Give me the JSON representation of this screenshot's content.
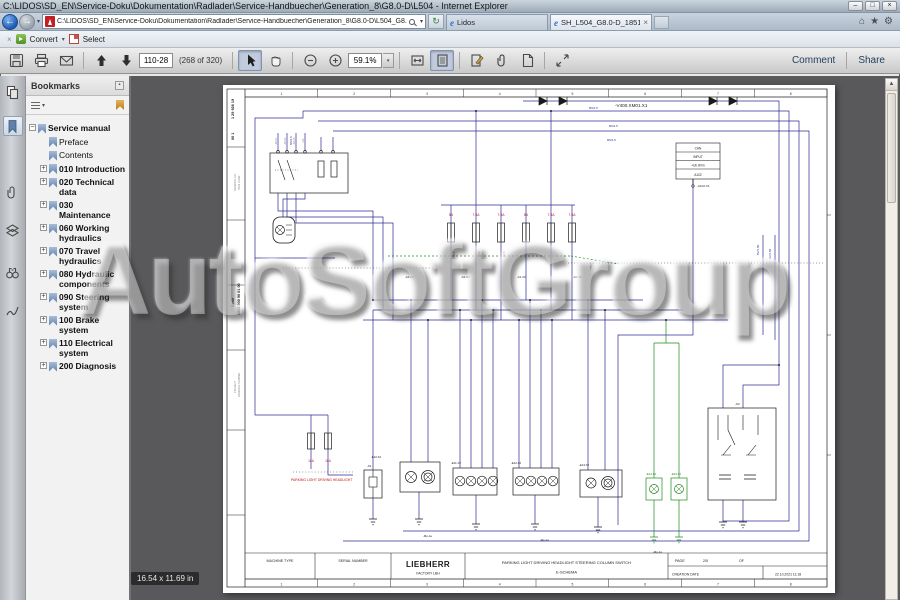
{
  "window": {
    "title": "C:\\LIDOS\\SD_EN\\Service-Doku\\Dokumentation\\Radlader\\Service-Handbuecher\\Generation_8\\G8.0-D\\L504 - Internet Explorer",
    "controls": {
      "minimize": "–",
      "restore": "□",
      "close": "×"
    }
  },
  "glyphs": {
    "back": "←",
    "forward": "→",
    "caret": "▾",
    "refresh": "↻",
    "home": "⌂",
    "star": "★",
    "gear": "⚙",
    "ie": "e",
    "tab_close": "×",
    "toolbar_close": "×",
    "scroll_up": "▲"
  },
  "nav": {
    "address": "C:\\LIDOS\\SD_EN\\Service-Doku\\Dokumentation\\Radlader\\Service-Handbuecher\\Generation_8\\G8.0-D\\L504_G8.0-D_1851\\SH_L504_G8.0-D_18",
    "tabs": [
      {
        "label": "Lidos",
        "active": false
      },
      {
        "label": "SH_L504_G8.0-D_1851_202...",
        "active": true
      }
    ]
  },
  "command_bar": {
    "convert_label": "Convert",
    "select_label": "Select"
  },
  "pdf_toolbar": {
    "page_field": "110-28",
    "page_count": "(268 of 320)",
    "zoom_value": "59.1%",
    "comment_label": "Comment",
    "share_label": "Share"
  },
  "bookmarks": {
    "header": "Bookmarks",
    "items": [
      {
        "label": "Service manual",
        "expander": "−"
      },
      {
        "label": "Preface",
        "expander": ""
      },
      {
        "label": "Contents",
        "expander": ""
      },
      {
        "label": "010 Introduction",
        "expander": "+"
      },
      {
        "label": "020 Technical data",
        "expander": "+"
      },
      {
        "label": "030 Maintenance",
        "expander": "+"
      },
      {
        "label": "060 Working hydraulics",
        "expander": "+"
      },
      {
        "label": "070 Travel hydraulics",
        "expander": "+"
      },
      {
        "label": "080 Hydraulic components",
        "expander": "+"
      },
      {
        "label": "090 Steering system",
        "expander": "+"
      },
      {
        "label": "100 Brake system",
        "expander": "+"
      },
      {
        "label": "110 Electrical system",
        "expander": "+"
      },
      {
        "label": "200 Diagnosis",
        "expander": "+"
      }
    ]
  },
  "watermark": {
    "text": "AutoSoftGroup"
  },
  "doc": {
    "size_tooltip": "16.54 x 11.69 in",
    "title_block": {
      "machine_type_label": "MACHINE TYPE",
      "serial_number_label": "SERIAL NUMBER",
      "brand": "LIEBHERR",
      "factory": "FACTORY  LBH",
      "title_line1": "PARKING LIGHT DRIVING HEADLIGHT STEERING COLUMN SWITCH",
      "title_line2": "E-SCHEMA",
      "page_label": "PAGE",
      "page_value": "2/5",
      "of_label": "OF",
      "creation_label": "CREATION DATE",
      "creation_value": "22.10.2021 11:18"
    },
    "schematic": {
      "columns": [
        "1",
        "2",
        "3",
        "4",
        "5",
        "6",
        "7",
        "8"
      ],
      "colors": {
        "wire_blue": "#2c2c96",
        "wire_green": "#1e8a1e",
        "label_red": "#c11212",
        "ink": "#1a1a1a"
      },
      "labels": [
        {
          "t": "-V400.XM01.X1",
          "x": 392,
          "y": 22,
          "fs": 4.6
        },
        {
          "t": "1 29 928 19",
          "x": 11,
          "y": 34,
          "fs": 3.8,
          "r": -90,
          "b": 1
        },
        {
          "t": "00 1",
          "x": 11,
          "y": 55,
          "fs": 3.8,
          "r": -90,
          "b": 1
        },
        {
          "t": "ITEM CODE",
          "x": 17,
          "y": 105,
          "c": "gr",
          "fs": 2.6,
          "r": -90
        },
        {
          "t": "DRAWING NO.",
          "x": 13,
          "y": 106,
          "c": "gr",
          "fs": 2.6,
          "r": -90
        },
        {
          "t": "Serie",
          "x": 11,
          "y": 222,
          "fs": 3.8,
          "r": -90,
          "b": 1
        },
        {
          "t": "1853 000 90 01 00",
          "x": 17,
          "y": 230,
          "fs": 3.8,
          "r": -90,
          "b": 1
        },
        {
          "t": "PROJECT",
          "x": 13,
          "y": 308,
          "c": "gr",
          "fs": 2.6,
          "r": -90
        },
        {
          "t": "DRAWING NUMBER",
          "x": 17,
          "y": 312,
          "c": "gr",
          "fs": 2.6,
          "r": -90
        },
        {
          "t": "5A",
          "x": 228,
          "y": 131,
          "c": "r",
          "fs": 3.4,
          "a": "m"
        },
        {
          "t": "7.5A",
          "x": 253,
          "y": 131,
          "c": "r",
          "fs": 3.4,
          "a": "m"
        },
        {
          "t": "7.5A",
          "x": 278,
          "y": 131,
          "c": "r",
          "fs": 3.4,
          "a": "m"
        },
        {
          "t": "5A",
          "x": 303,
          "y": 131,
          "c": "r",
          "fs": 3.4,
          "a": "m"
        },
        {
          "t": "7.5A",
          "x": 328,
          "y": 131,
          "c": "r",
          "fs": 3.4,
          "a": "m"
        },
        {
          "t": "7.5A",
          "x": 349,
          "y": 131,
          "c": "r",
          "fs": 3.4,
          "a": "m"
        },
        {
          "t": "M4.8",
          "x": 232,
          "y": 172,
          "c": "r",
          "fs": 2.4,
          "r": -90
        },
        {
          "t": "M4.8",
          "x": 257,
          "y": 172,
          "c": "r",
          "fs": 2.4,
          "r": -90
        },
        {
          "t": "M4.8",
          "x": 282,
          "y": 172,
          "c": "r",
          "fs": 2.4,
          "r": -90
        },
        {
          "t": "10A",
          "x": 88,
          "y": 377,
          "c": "r",
          "fs": 3.2,
          "a": "m"
        },
        {
          "t": "10A",
          "x": 105,
          "y": 377,
          "c": "r",
          "fs": 3.2,
          "a": "m"
        },
        {
          "t": "PARKING LIGHT DRIVING HEADLIGHT",
          "x": 68,
          "y": 396,
          "c": "r",
          "fs": 3.4
        },
        {
          "t": "CAN",
          "x": 475,
          "y": 64.5,
          "fs": 3.2,
          "a": "m"
        },
        {
          "t": "INPUT",
          "x": 475,
          "y": 73,
          "fs": 3.2,
          "a": "m"
        },
        {
          "t": "+Ub  8Vm",
          "x": 475,
          "y": 81.5,
          "fs": 3.2,
          "a": "m"
        },
        {
          "t": "A102",
          "x": 475,
          "y": 91,
          "fs": 3.2,
          "a": "m"
        },
        {
          "t": "-A102.X1",
          "x": 474,
          "y": 102,
          "fs": 3
        },
        {
          "t": "8V/1.50",
          "x": 536,
          "y": 170,
          "c": "b",
          "fs": 3,
          "r": -90
        },
        {
          "t": "9V/1.50",
          "x": 548,
          "y": 174,
          "c": "b",
          "fs": 3,
          "r": -90
        },
        {
          "t": "8N/1.5",
          "x": 366,
          "y": 24,
          "c": "b",
          "fs": 3
        },
        {
          "t": "8N/1.5",
          "x": 386,
          "y": 42,
          "c": "b",
          "fs": 3
        },
        {
          "t": "8N/1.5",
          "x": 384,
          "y": 56,
          "c": "b",
          "fs": 3
        },
        {
          "t": "8N/1.5",
          "x": 69,
          "y": 60,
          "c": "b",
          "fs": 3,
          "r": -90
        },
        {
          "t": "-S8.X1",
          "x": 54,
          "y": 60,
          "c": "gr",
          "fs": 2.4,
          "r": -90
        },
        {
          "t": "-S8.X2",
          "x": 63,
          "y": 60,
          "c": "gr",
          "fs": 2.4,
          "r": -90
        },
        {
          "t": "-S8.X3",
          "x": 72,
          "y": 60,
          "c": "gr",
          "fs": 2.4,
          "r": -90
        },
        {
          "t": "+S3",
          "x": 81,
          "y": 58,
          "c": "gr",
          "fs": 2.4,
          "r": -90
        },
        {
          "t": "-A1.X2",
          "x": 182,
          "y": 193,
          "fs": 2.8
        },
        {
          "t": "-A1.X2",
          "x": 238,
          "y": 193,
          "fs": 2.8
        },
        {
          "t": "-A1.X2",
          "x": 294,
          "y": 193,
          "fs": 2.8
        },
        {
          "t": "-A1.X2",
          "x": 350,
          "y": 193,
          "fs": 2.8
        },
        {
          "t": "-E10.X2",
          "x": 148,
          "y": 373,
          "fs": 2.8
        },
        {
          "t": "-E11.X2",
          "x": 228,
          "y": 379,
          "fs": 2.8
        },
        {
          "t": "-E12.X2",
          "x": 288,
          "y": 379,
          "fs": 2.8
        },
        {
          "t": "-E13.X2",
          "x": 356,
          "y": 381,
          "fs": 2.8
        },
        {
          "t": "-S1",
          "x": 144,
          "y": 382,
          "fs": 2.8
        },
        {
          "t": "-K2",
          "x": 512,
          "y": 320,
          "fs": 3
        },
        {
          "t": "-Mp-1a",
          "x": 200,
          "y": 452,
          "fs": 2.8
        },
        {
          "t": "-Mp-1a",
          "x": 317,
          "y": 456,
          "fs": 2.8
        },
        {
          "t": "-Mp-1a",
          "x": 430,
          "y": 468,
          "fs": 2.8
        },
        {
          "t": "-E14.X2",
          "x": 423,
          "y": 390,
          "c": "g",
          "fs": 2.8
        },
        {
          "t": "-E15.X2",
          "x": 448,
          "y": 390,
          "c": "g",
          "fs": 2.8
        }
      ]
    }
  }
}
